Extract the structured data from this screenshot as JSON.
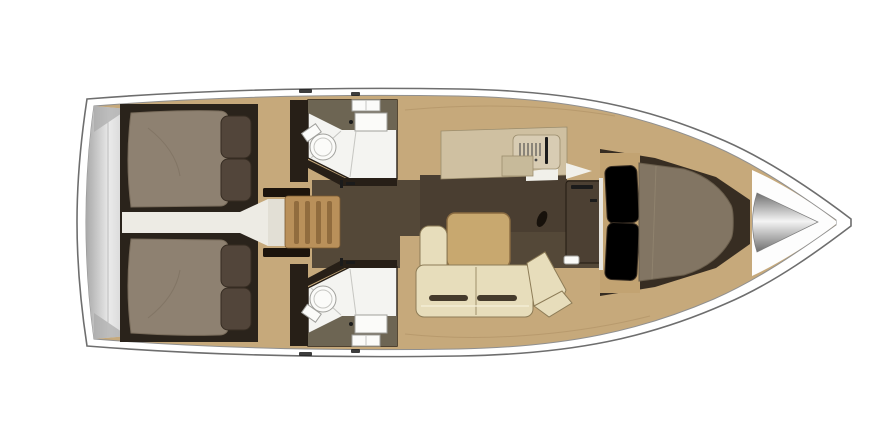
{
  "meta": {
    "description": "Overhead interior layout plan of a sailing yacht, bow pointing right, no text labels",
    "canvas": {
      "width": 890,
      "height": 446
    }
  },
  "scene": {
    "stern": "swim-platform",
    "aft": [
      "port-aft-double-cabin",
      "starboard-aft-double-cabin",
      "central-corridor",
      "companionway-steps"
    ],
    "midship": [
      "port-head-with-shower-and-toilet",
      "starboard-head-with-shower-and-toilet",
      "port-galley-with-stove-and-fridge",
      "salon-table",
      "l-shaped-settee",
      "mast-post",
      "nav-cabinet"
    ],
    "forward": [
      "v-berth-double-cabin",
      "anchor-locker-cone"
    ]
  },
  "colors": {
    "page_bg": "#ffffff",
    "hull_white": "#ffffff",
    "hull_stroke": "#6e6e6e",
    "hull_inner_stroke": "#909090",
    "deck_wood": "#c6a97b",
    "deck_seam": "#a98c5f",
    "platform_gray": "#d2d2d2",
    "platform_light": "#eaeaea",
    "platform_edge": "#a9a9a9",
    "aft_block": "#2a231b",
    "aft_mattress": "#8e8171",
    "mattress_crease": "#796c5b",
    "pillow_dark": "#52453a",
    "pillow_stroke": "#362c22",
    "corridor_white": "#edebe4",
    "landing_white": "#e2dfd5",
    "steps_wood": "#b9905a",
    "steps_tread": "#916c3e",
    "steps_frame": "#1c140c",
    "head_wall": "#271f17",
    "counter_olive": "#6d6553",
    "shower_white": "#f4f4f1",
    "shower_seam": "#c6c6c2",
    "fixture_white": "#fbfbf9",
    "fixture_stroke": "#a0a09c",
    "fitting_dark": "#1b1b1b",
    "salon_floor": "#544838",
    "galley_dark": "#4a3e31",
    "galley_counter": "#cfc0a1",
    "stove_panel": "#d8ccb3",
    "stove_mark": "#4a4a4a",
    "fridge_panel": "#c7ba9a",
    "hatch_white": "#f1f0ea",
    "table_wood": "#c8a86f",
    "table_stroke": "#8a6b41",
    "sofa_cream": "#e7ddbb",
    "sofa_stroke": "#8d7c57",
    "sofa_slot": "#453a2b",
    "nav_cabinet": "#4c4033",
    "nav_stroke": "#221a11",
    "fwd_surround": "#372d22",
    "fwd_mattress": "#827563",
    "fwd_mattress_stroke": "#6b5f4d",
    "fwd_crease": "#948772",
    "headboard_wood": "#c2a372",
    "bulkhead_white": "#e7e5df",
    "mast_dark": "#17110b",
    "white_bow": "#fdfdfd",
    "cone_dark": "#6f6f6f",
    "cone_light": "#f4f4f4"
  }
}
